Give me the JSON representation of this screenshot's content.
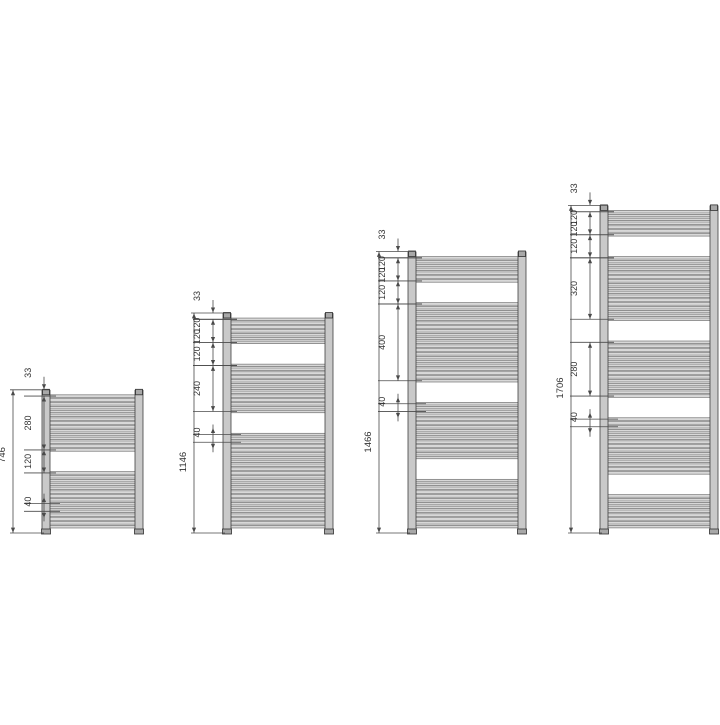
{
  "diagram": {
    "type": "towel-radiator-dimension-drawing",
    "unit": "mm",
    "colors": {
      "background": "#ffffff",
      "dim_line": "#4a4a4a",
      "label_text": "#333333",
      "tube_fill": "#c9c9c9",
      "tube_stroke": "#3f3f3f",
      "bar_fill": "#d8d8d8",
      "bar_stroke": "#565656",
      "cap_fill": "#a8a8a8",
      "cap_stroke": "#2f2f2f"
    },
    "radiators": [
      {
        "id": "746",
        "total_label": "746",
        "height_mm": 746,
        "top_margin_mm": 33,
        "bottom_margin_mm": 33,
        "sections": [
          {
            "type": "tubes",
            "count": 15,
            "span_mm": 280
          },
          {
            "type": "gap",
            "span_mm": 120
          },
          {
            "type": "tubes",
            "count": 15,
            "span_mm": 280
          }
        ],
        "dims": [
          {
            "kind": "top",
            "from_mm": 0,
            "to_mm": 33,
            "labels": [
              "33"
            ]
          },
          {
            "kind": "seg",
            "from_mm": 33,
            "to_mm": 313,
            "labels": [
              "280"
            ]
          },
          {
            "kind": "seg",
            "from_mm": 313,
            "to_mm": 433,
            "labels": [
              "120"
            ]
          },
          {
            "kind": "small",
            "from_mm": 593,
            "to_mm": 633,
            "labels": [
              "40"
            ]
          }
        ]
      },
      {
        "id": "1146",
        "total_label": "1146",
        "height_mm": 1146,
        "top_margin_mm": 33,
        "bottom_margin_mm": 33,
        "sections": [
          {
            "type": "tubes",
            "count": 7,
            "span_mm": 120
          },
          {
            "type": "gap",
            "span_mm": 120
          },
          {
            "type": "tubes",
            "count": 13,
            "span_mm": 240
          },
          {
            "type": "gap",
            "span_mm": 120
          },
          {
            "type": "tubes",
            "count": 25,
            "span_mm": 480
          }
        ],
        "dims": [
          {
            "kind": "top",
            "from_mm": 0,
            "to_mm": 33,
            "labels": [
              "33"
            ]
          },
          {
            "kind": "seg",
            "from_mm": 33,
            "to_mm": 153,
            "labels": [
              "120",
              "120"
            ]
          },
          {
            "kind": "seg",
            "from_mm": 153,
            "to_mm": 273,
            "labels": [
              "120"
            ]
          },
          {
            "kind": "seg",
            "from_mm": 273,
            "to_mm": 513,
            "labels": [
              "240"
            ]
          },
          {
            "kind": "small",
            "from_mm": 633,
            "to_mm": 673,
            "labels": [
              "40"
            ]
          }
        ]
      },
      {
        "id": "1466",
        "total_label": "1466",
        "height_mm": 1466,
        "top_margin_mm": 33,
        "bottom_margin_mm": 33,
        "sections": [
          {
            "type": "tubes",
            "count": 7,
            "span_mm": 120
          },
          {
            "type": "gap",
            "span_mm": 120
          },
          {
            "type": "tubes",
            "count": 21,
            "span_mm": 400
          },
          {
            "type": "gap",
            "span_mm": 120
          },
          {
            "type": "tubes",
            "count": 15,
            "span_mm": 280
          },
          {
            "type": "gap",
            "span_mm": 120
          },
          {
            "type": "tubes",
            "count": 13,
            "span_mm": 240
          }
        ],
        "dims": [
          {
            "kind": "top",
            "from_mm": 0,
            "to_mm": 33,
            "labels": [
              "33"
            ]
          },
          {
            "kind": "seg",
            "from_mm": 33,
            "to_mm": 153,
            "labels": [
              "120",
              "120"
            ]
          },
          {
            "kind": "seg",
            "from_mm": 153,
            "to_mm": 273,
            "labels": [
              "120"
            ]
          },
          {
            "kind": "seg",
            "from_mm": 273,
            "to_mm": 673,
            "labels": [
              "400"
            ]
          },
          {
            "kind": "small",
            "from_mm": 793,
            "to_mm": 833,
            "labels": [
              "40"
            ]
          }
        ]
      },
      {
        "id": "1706",
        "total_label": "1706",
        "height_mm": 1706,
        "top_margin_mm": 33,
        "bottom_margin_mm": 33,
        "sections": [
          {
            "type": "tubes",
            "count": 7,
            "span_mm": 120
          },
          {
            "type": "gap",
            "span_mm": 120
          },
          {
            "type": "tubes",
            "count": 17,
            "span_mm": 320
          },
          {
            "type": "gap",
            "span_mm": 120
          },
          {
            "type": "tubes",
            "count": 15,
            "span_mm": 280
          },
          {
            "type": "gap",
            "span_mm": 120
          },
          {
            "type": "tubes",
            "count": 15,
            "span_mm": 280
          },
          {
            "type": "gap",
            "span_mm": 120
          },
          {
            "type": "tubes",
            "count": 9,
            "span_mm": 160
          }
        ],
        "dims": [
          {
            "kind": "top",
            "from_mm": 0,
            "to_mm": 33,
            "labels": [
              "33"
            ]
          },
          {
            "kind": "seg",
            "from_mm": 33,
            "to_mm": 153,
            "labels": [
              "120",
              "120"
            ]
          },
          {
            "kind": "seg",
            "from_mm": 153,
            "to_mm": 273,
            "labels": [
              "120"
            ]
          },
          {
            "kind": "seg",
            "from_mm": 273,
            "to_mm": 593,
            "labels": [
              "320"
            ]
          },
          {
            "kind": "seg",
            "from_mm": 713,
            "to_mm": 993,
            "labels": [
              "280"
            ]
          },
          {
            "kind": "small",
            "from_mm": 1113,
            "to_mm": 1153,
            "labels": [
              "40"
            ]
          }
        ]
      }
    ]
  }
}
